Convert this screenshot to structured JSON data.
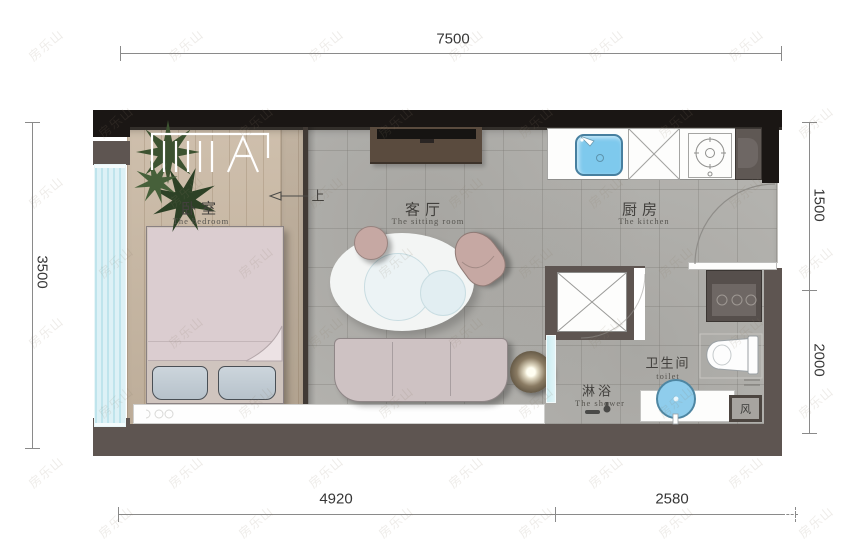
{
  "watermark": {
    "text": "房乐山"
  },
  "dimensions": {
    "top": "7500",
    "left": "3500",
    "right_upper": "1500",
    "right_lower": "2000",
    "bottom_left": "4920",
    "bottom_right": "2580"
  },
  "rooms": {
    "bedroom": {
      "zh": "卧室",
      "en": "The bedroom"
    },
    "sitting_room": {
      "zh": "客厅",
      "en": "The sitting room"
    },
    "kitchen": {
      "zh": "厨房",
      "en": "The kitchen"
    },
    "toilet": {
      "zh": "卫生间",
      "en": "toilet"
    },
    "shower": {
      "zh": "淋浴",
      "en": "The shower"
    }
  },
  "annotations": {
    "step_up": "上",
    "vent": "风"
  },
  "colors": {
    "wall_black": "#1a1614",
    "wall_gray": "#5e5551",
    "wood_floor": "#c9b8a3",
    "tile_floor": "#b3b2ae",
    "window_glass": "#cdeef3",
    "sink_blue": "#7ec9ed",
    "basin_blue": "#8fcdec",
    "duvet_pink": "#dbcdd0",
    "sofa_mauve": "#cec2c3",
    "chair_pink": "#c6a8a3"
  }
}
